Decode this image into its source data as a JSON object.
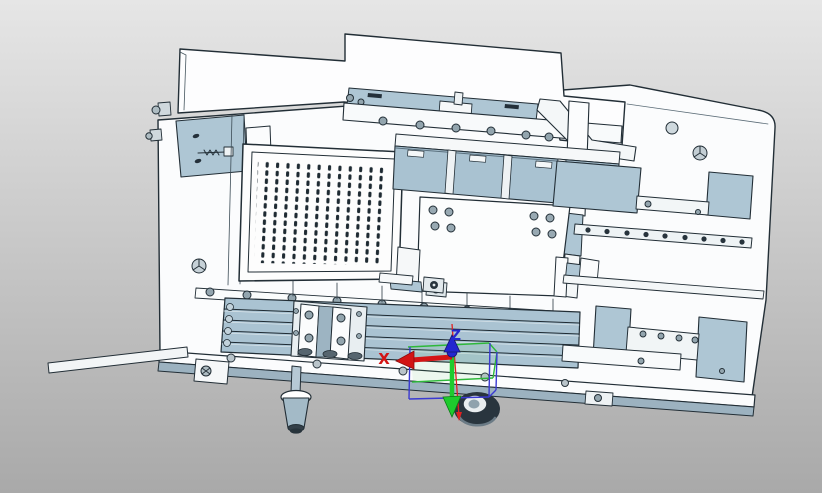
{
  "viewport": {
    "description": "3D CAD viewport showing a machined fixture-plate assembly in shaded-with-edges view",
    "background_top": "#e6e6e6",
    "background_bottom": "#a9a9a9"
  },
  "triad": {
    "x_label": "X",
    "z_label": "Z",
    "x_color": "#d31414",
    "y_color": "#1ecb2d",
    "z_color": "#2326cf",
    "selection_box_green": "#2eb83a",
    "selection_box_blue": "#3a3ad1",
    "origin_screen_xy": [
      452,
      354
    ]
  },
  "palette": {
    "part_white": "#fbfcfd",
    "steel_blue": "#aec6d4",
    "steel_blue_dark": "#9cb2c0",
    "edge_dark": "#222e36",
    "hardware_dark": "#27333c"
  },
  "model": {
    "parts": [
      {
        "name": "back-plate",
        "finish": "white"
      },
      {
        "name": "base-plate",
        "finish": "white"
      },
      {
        "name": "upper-screw-rail",
        "screws": 6
      },
      {
        "name": "left-clamp-plate",
        "finish": "steel-blue"
      },
      {
        "name": "spring-plunger"
      },
      {
        "name": "perforated-plate",
        "slot_rows": 13,
        "slot_columns": 13
      },
      {
        "name": "center-channel",
        "finish": "steel-blue"
      },
      {
        "name": "center-mounting-plate",
        "screws": 8
      },
      {
        "name": "right-column-and-brace"
      },
      {
        "name": "upper-pocket-recess",
        "finish": "steel-blue"
      },
      {
        "name": "hole-strip",
        "holes": 9
      },
      {
        "name": "lower-pocket-recess",
        "screws": 4
      },
      {
        "name": "linear-rail",
        "ridge_lines": 4
      },
      {
        "name": "slider-block",
        "screws": 4
      },
      {
        "name": "front-edge-strip",
        "holes": 4
      },
      {
        "name": "left-extension-bar"
      },
      {
        "name": "leveling-foot"
      },
      {
        "name": "caster-wheel"
      }
    ]
  }
}
